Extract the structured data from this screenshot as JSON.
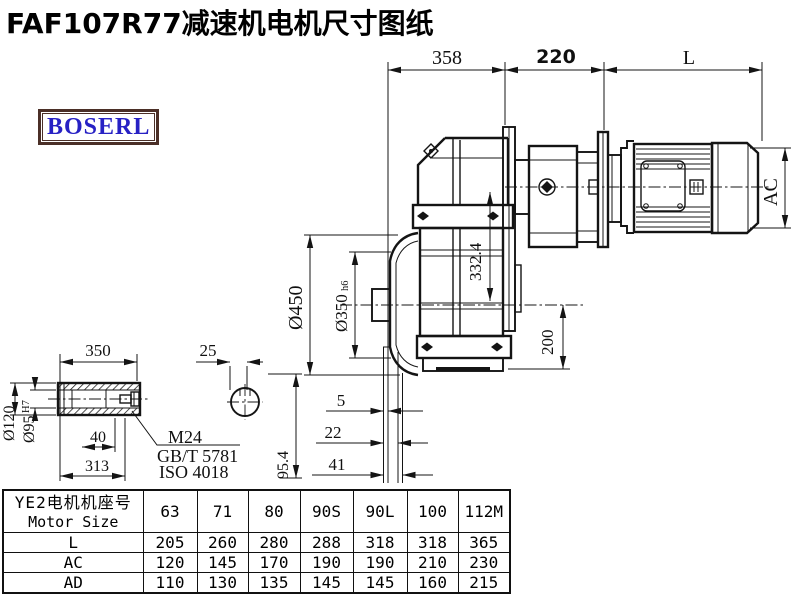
{
  "title": "FAF107R77减速机电机尺寸图纸",
  "logo": {
    "text": "BOSERL"
  },
  "drawing": {
    "dims": {
      "top358": "358",
      "top220": "220",
      "topL": "L",
      "ac": "AC",
      "v332": "332.4",
      "d450": "Ø450",
      "d350": "Ø350",
      "d350tol": "h6",
      "h200": "200",
      "g5": "5",
      "g22": "22",
      "g41": "41",
      "s350": "350",
      "k25": "25",
      "b40": "40",
      "b313": "313",
      "h954": "95.4",
      "d120": "Ø120",
      "d95": "Ø95",
      "d95tol": "H7",
      "thread": "M24",
      "std_gb": "GB/T 5781",
      "std_iso": "ISO 4018"
    }
  },
  "table": {
    "header_cn": "YE2电机机座号",
    "header_en": "Motor Size",
    "columns": [
      "63",
      "71",
      "80",
      "90S",
      "90L",
      "100",
      "112M"
    ],
    "rows": [
      {
        "label": "L",
        "values": [
          "205",
          "260",
          "280",
          "288",
          "318",
          "318",
          "365"
        ]
      },
      {
        "label": "AC",
        "values": [
          "120",
          "145",
          "170",
          "190",
          "190",
          "210",
          "230"
        ]
      },
      {
        "label": "AD",
        "values": [
          "110",
          "130",
          "135",
          "145",
          "145",
          "160",
          "215"
        ]
      }
    ]
  },
  "colors": {
    "line": "#141414",
    "logo_border": "#4b2f27",
    "logo_text": "#2721c4"
  }
}
